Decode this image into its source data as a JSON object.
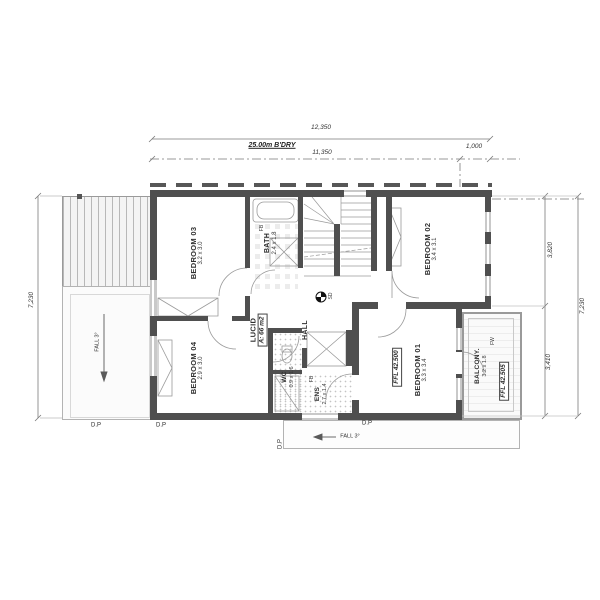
{
  "drawing": {
    "title": "First floor plan",
    "dims_top": {
      "total": "12,350",
      "boundary": "25.00m B'DRY",
      "inner": "11,350",
      "offset": "1,000"
    },
    "dims_left": {
      "total": "7,230"
    },
    "dims_right": {
      "upper": "3,820",
      "lower": "3,410",
      "total": "7,230"
    },
    "rooms": {
      "bedroom03": {
        "name": "BEDROOM 03",
        "size": "3.2 x 3.0"
      },
      "bath": {
        "name": "BATH",
        "size": "2.4 x 1.8",
        "fixture": "FB"
      },
      "bedroom02": {
        "name": "BEDROOM 02",
        "size": "3.4 x 3.1"
      },
      "lucid": {
        "name": "LUCID",
        "area": "A: 66 m2"
      },
      "hall": {
        "name": "HALL",
        "smoke_detector": "SD"
      },
      "bedroom04": {
        "name": "BEDROOM 04",
        "size": "2.9 x 3.0"
      },
      "wc": {
        "name": "WC",
        "size": "0.9 x 1.6"
      },
      "ens": {
        "name": "ENS",
        "size": "2.7 x 1.4",
        "fixture": "FB"
      },
      "bedroom01": {
        "name": "BEDROOM 01",
        "size": "3.3 x 3.4",
        "ffl": "FFL 42.500"
      },
      "balcony": {
        "name": "BALCONY.",
        "size": "3.2 x 1.8",
        "ffl": "FFL 42.505",
        "note": "FW"
      }
    },
    "annotations": {
      "fall_left": "FALL 3°",
      "fall_bottom": "FALL 3°",
      "downpipe": "D.P"
    },
    "colors": {
      "wall": "#4f4f4f",
      "line": "#8c8c8c",
      "window": "#d8d8d8"
    }
  }
}
